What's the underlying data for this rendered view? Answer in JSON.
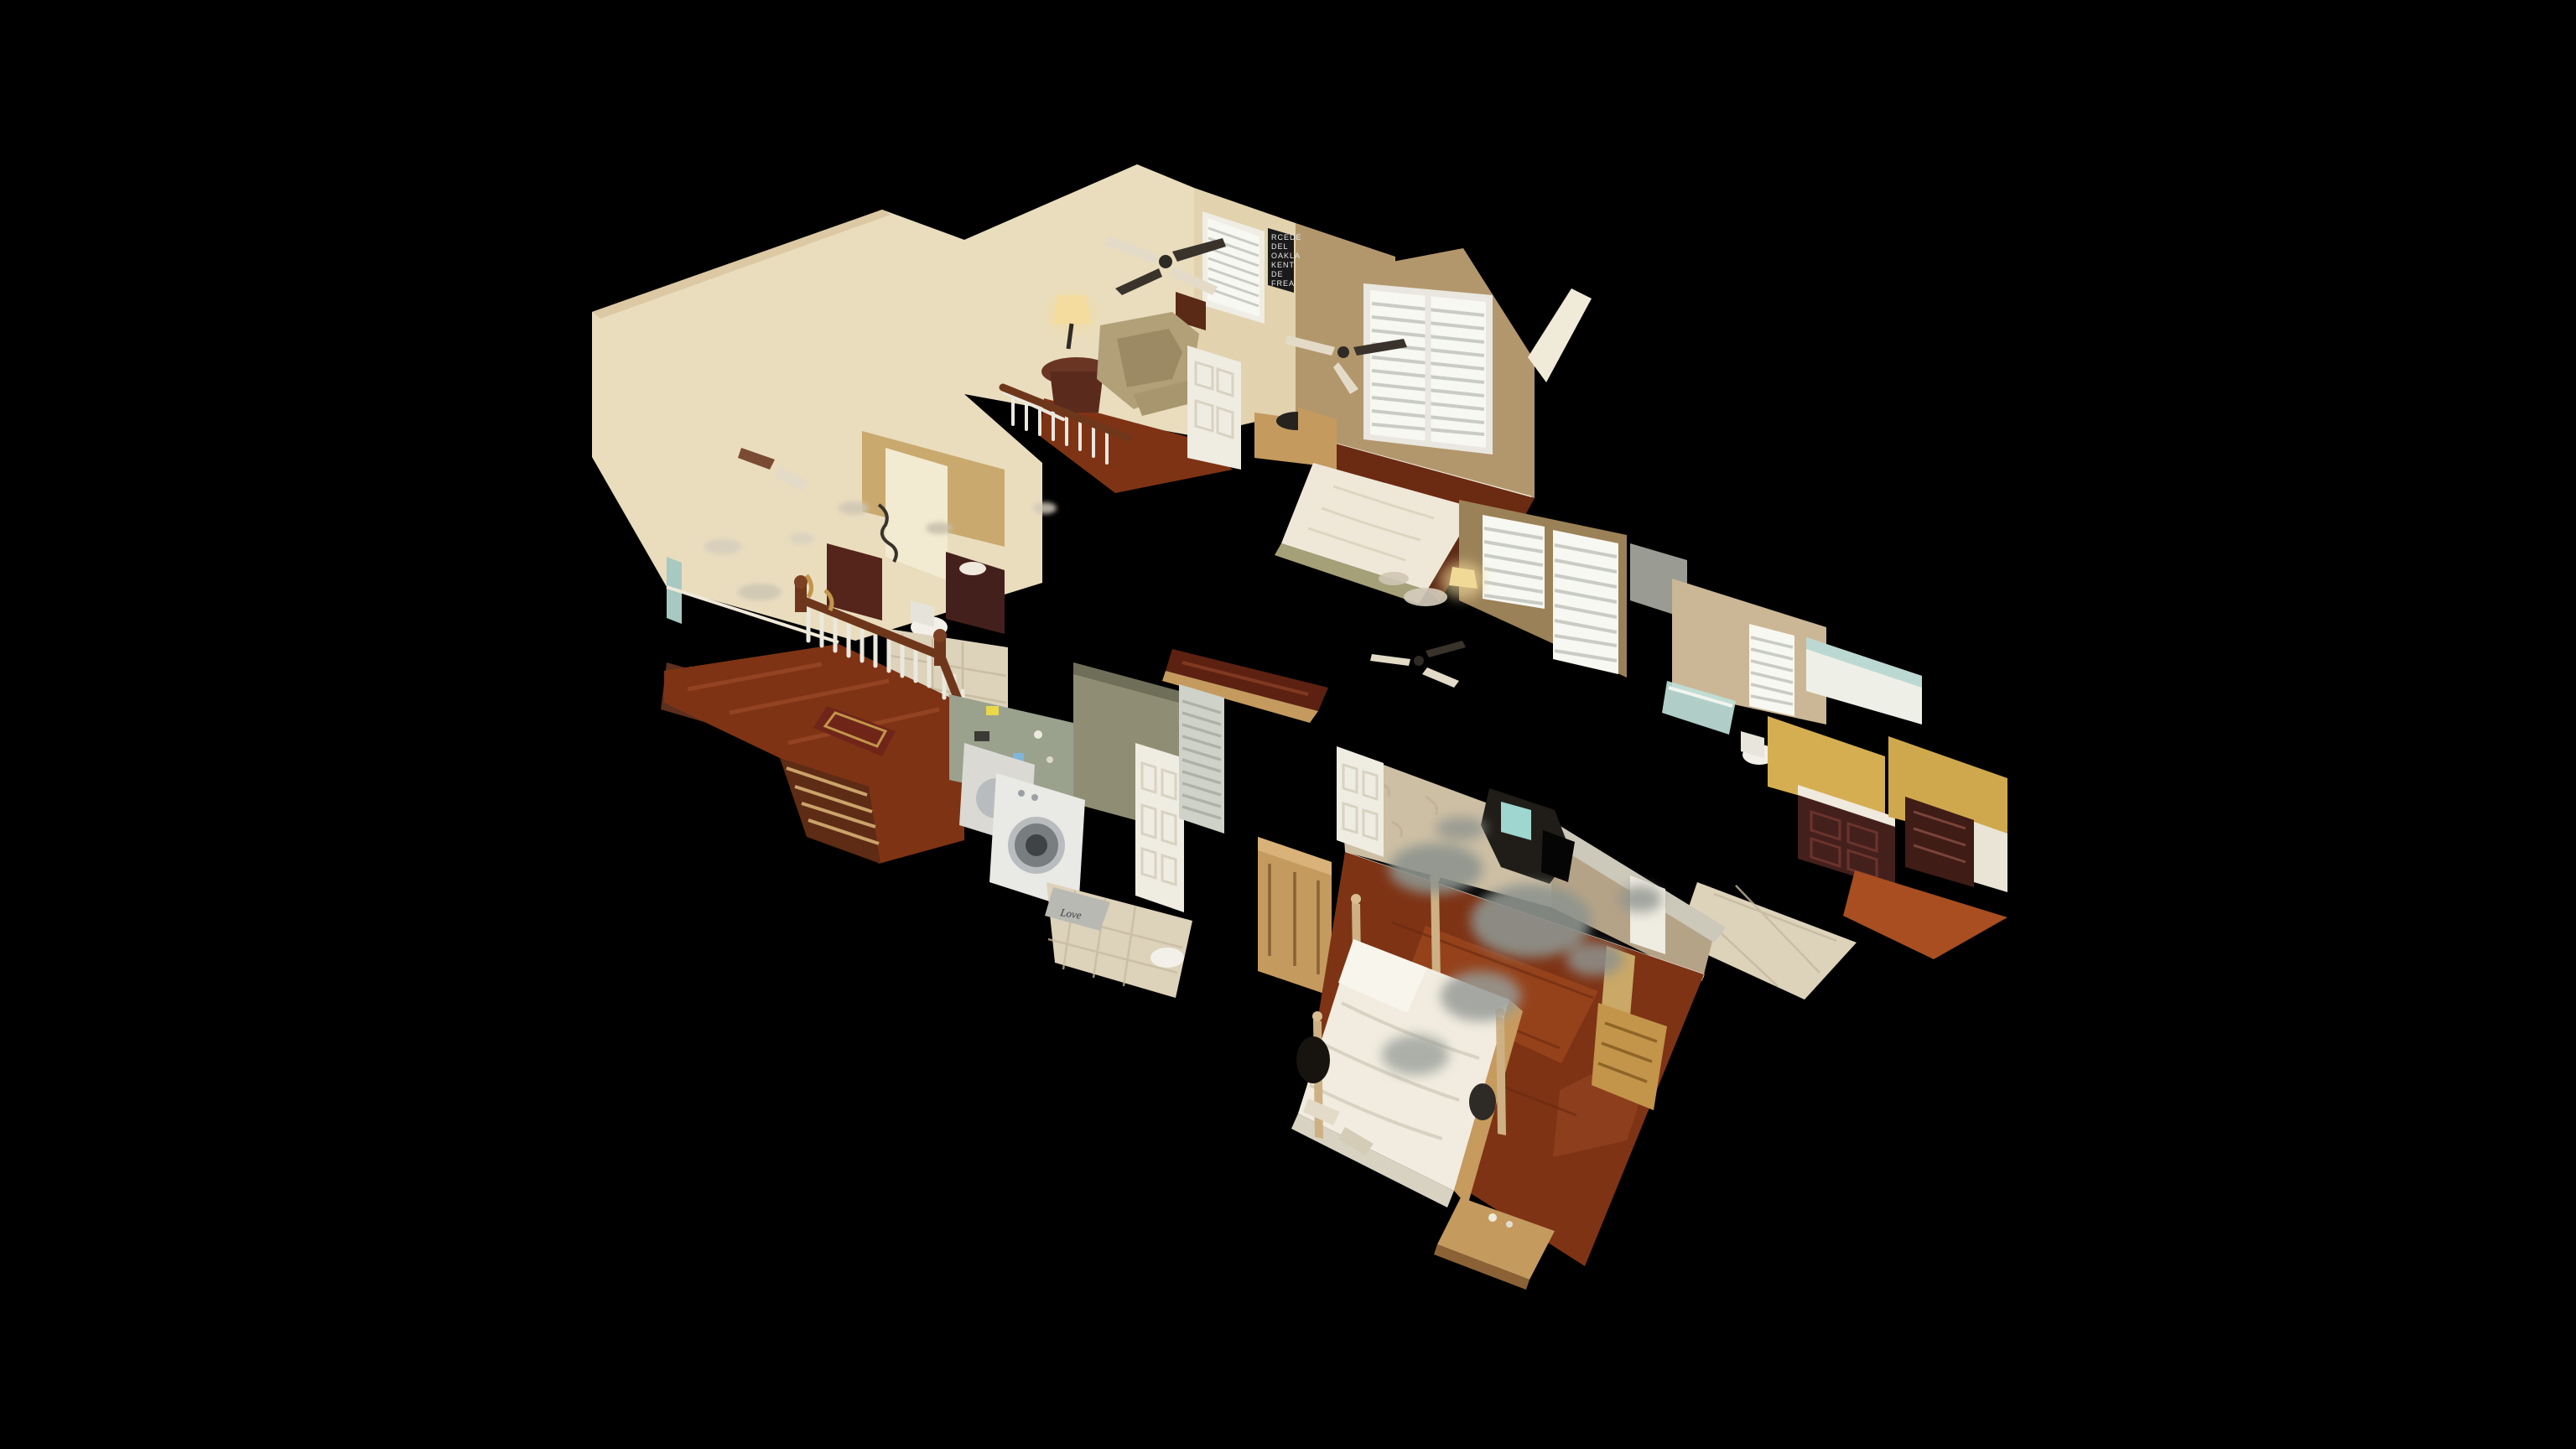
{
  "scene": {
    "type": "3d-dollhouse-view",
    "description": "Matterport-style textured 3D dollhouse cutaway of a two-story house interior seen from above at an angle, floating on a solid black background. Upstairs loft with leather armchair and ceiling fans, guest bedroom with shuttered window and lace-covered bed, hall bathroom with mirror and cherry vanity, laundry room with white washer and dryer, master bedroom with white four-poster bed on glossy red-brown wood floors, master bath with shower glass and cherry vanity, gray scan-hole artifacts and floating mesh debris throughout.",
    "background_color": "#000000"
  },
  "palette": {
    "background": "#000000",
    "wall_cream": "#e9ddbe",
    "wall_cream_shade": "#dcc9a4",
    "wall_tan": "#b3976c",
    "wall_tan_dark": "#9b8157",
    "wallpaper_beige": "#cdbfa4",
    "wallpaper_shade": "#b5a387",
    "cut_plane_gray": "#ccc8ba",
    "floor_wood_red": "#7e3315",
    "floor_wood_bright": "#a84e21",
    "floor_tile_beige": "#ddd2ba",
    "stair_wood_brown": "#6e371b",
    "spindle_white": "#ebe8de",
    "rug_red": "#6f2518",
    "washer_white": "#e9e9e5",
    "door_white": "#efece1",
    "sage_green": "#8f8e74",
    "counter_cherry": "#5c2111",
    "vanity_cherry": "#44201c",
    "yellow_wall": "#d6ae52",
    "shower_glass_blue": "#bfdfd8",
    "window_bright": "#f7f8f2",
    "bed_white": "#f1ecdf",
    "coverlet_white": "#efe8d8",
    "scan_hole_gray": "#8e938e",
    "sign_black": "#1a1a1a",
    "lamp_glow": "#f3dc9e",
    "leather_tan": "#b2a078",
    "wood_oak": "#c49a5f",
    "dark_wood": "#53250f",
    "teal_glint": "#9fd6d0",
    "gold": "#c2954b",
    "fan_dark": "#39332c",
    "fan_cream": "#e3dbc8"
  },
  "sign": {
    "name": "black-roll-sign-wall-art",
    "lines": [
      "RCEDE",
      "DEL",
      "OAKLA",
      "KENT",
      "DE",
      "FREA"
    ]
  },
  "door_mat": {
    "text": "Love"
  },
  "features": [
    "two-story foyer wall",
    "upstairs landing with wood banister and white spindles",
    "staircase descending out of cut plane",
    "oriental runner rug",
    "loft sitting room with leather armchair, round side table and lamp",
    "ceiling fans seen from above",
    "window with white plantation shutters",
    "black roll-sign wall art",
    "guest bed with white crochet coverlet",
    "hall bathroom with lit mirror, cherry vanity and toilet",
    "laundry room with white front-load washer and dryer",
    "white six-panel doors",
    "louvered closet door",
    "light oak armoire",
    "master bedroom with white four-poster bed",
    "glossy red-brown hardwood floor",
    "textured wallpaper walls with gray scan holes",
    "nightstand with dark lamp",
    "master bath with pale blue shower glass, yellow wall and cherry vanity",
    "tile floors",
    "far-right closet with dark cherry dresser",
    "floating scan debris fragments"
  ]
}
